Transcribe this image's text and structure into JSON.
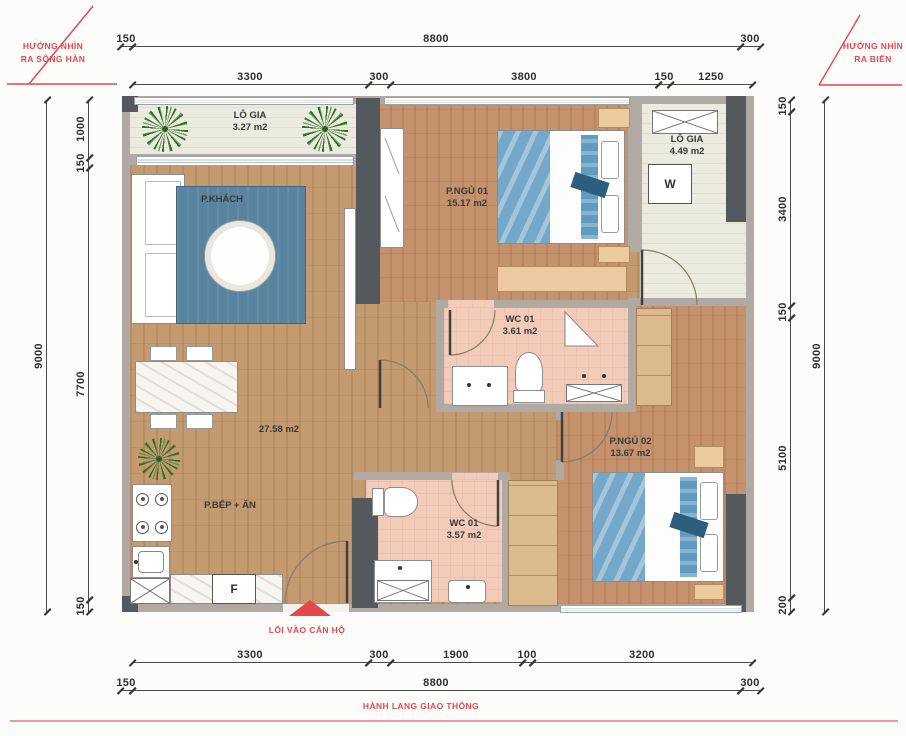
{
  "annotations": {
    "view_left_line1": "HƯỚNG NHÌN",
    "view_left_line2": "RA SÔNG HÀN",
    "view_right_line1": "HƯỚNG NHÌN",
    "view_right_line2": "RA BIỂN",
    "entrance_label": "LỐI VÀO CĂN HỘ",
    "corridor_label": "HÀNH LANG GIAO THÔNG"
  },
  "dimensions": {
    "top_outer": [
      "150",
      "8800",
      "300"
    ],
    "top_inner": [
      "3300",
      "300",
      "3800",
      "150",
      "1250"
    ],
    "bottom_inner": [
      "3300",
      "300",
      "1900",
      "100",
      "3200"
    ],
    "bottom_outer": [
      "150",
      "8800",
      "300"
    ],
    "left_outer": [
      "9000"
    ],
    "left_inner": [
      "1000",
      "150",
      "7700",
      "150"
    ],
    "right_inner": [
      "150",
      "3400",
      "150",
      "5100",
      "200"
    ],
    "right_outer": [
      "9000"
    ]
  },
  "rooms": {
    "balcony_left": {
      "name": "LÔ GIA",
      "area": "3.27 m2"
    },
    "living": {
      "name": "P.KHÁCH"
    },
    "bedroom1": {
      "name": "P.NGỦ 01",
      "area": "15.17 m2"
    },
    "balcony_right": {
      "name": "LÔ GIA",
      "area": "4.49 m2"
    },
    "wc1": {
      "name": "WC 01",
      "area": "3.61 m2"
    },
    "bedroom2": {
      "name": "P.NGỦ 02",
      "area": "13.67 m2"
    },
    "kitchen_dining": {
      "name": "P.BẾP + ĂN",
      "total_area": "27.58 m2"
    },
    "wc2": {
      "name": "WC 01",
      "area": "3.57 m2"
    }
  },
  "appliances": {
    "washer_label": "W",
    "fridge_label": "F"
  },
  "colors": {
    "annotation_red": "#e4484d",
    "dimension_text": "#2e2e2e",
    "wood_floor": "#c49a70",
    "bedroom_floor": "#c5926e",
    "wc_floor": "#f2cbb9",
    "balcony_floor": "#ebebdf",
    "wall_light": "#b1aaa4",
    "wall_dark": "#54595e",
    "rug_blue": "#58849f",
    "bed_blanket_blue": "#74a7c8",
    "cabinet_tan": "#dcba90"
  }
}
